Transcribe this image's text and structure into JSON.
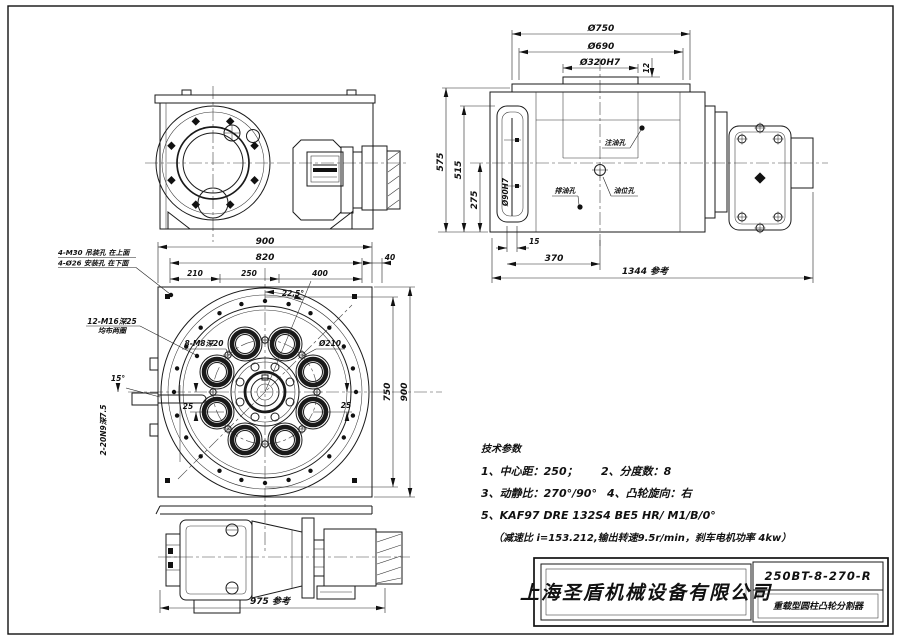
{
  "side_view": {
    "dims": {
      "d750": "Ø750",
      "d690": "Ø690",
      "d320": "Ø320H7",
      "d12": "12",
      "d575": "575",
      "d515": "515",
      "d275": "275",
      "d90": "Ø90H7",
      "d15": "15",
      "d370": "370",
      "d1344": "1344 参考"
    },
    "labels": {
      "fill": "注油孔",
      "drain": "排油孔",
      "level": "油位孔"
    }
  },
  "top_view": {
    "dims": {
      "d900t": "900",
      "d820": "820",
      "d210": "210",
      "d250": "250",
      "d400": "400",
      "d40": "40",
      "d750r": "750",
      "d900r": "900",
      "a225": "22.5°",
      "a15": "15°",
      "d25l": "25",
      "d25r": "25",
      "dia210": "Ø210",
      "d975": "975 参考"
    },
    "labels": {
      "lift1": "4-M30 吊装孔 在上面",
      "lift2": "4-Ø26 安装孔 在下面",
      "tap1": "12-M16深25",
      "tap1b": "均布两圈",
      "tap2": "8-M8深20",
      "key": "2-20N9深7.5"
    }
  },
  "tech_params": {
    "heading": "技术参数",
    "p1": "1、中心距：250；",
    "p2": "2、分度数：8",
    "p3": "3、动静比：270°/90°",
    "p4": "4、凸轮旋向：右",
    "p5": "5、KAF97 DRE 132S4 BE5 HR/ M1/B/0°",
    "p6": "（减速比 i=153.212,输出转速9.5r/min，刹车电机功率 4kw）"
  },
  "title_block": {
    "company": "上海圣盾机械设备有限公司",
    "model": "250BT-8-270-R",
    "product": "重载型圆柱凸轮分割器"
  }
}
